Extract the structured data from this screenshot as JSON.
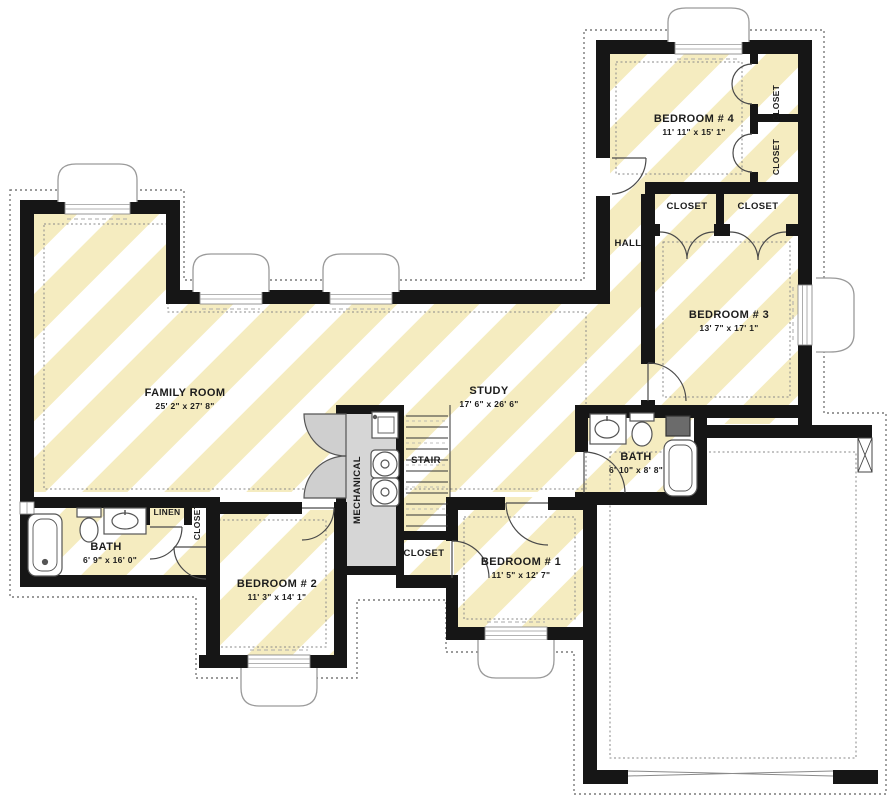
{
  "plan": {
    "type": "floor-plan",
    "level": "basement",
    "colors": {
      "wall": "#161616",
      "stripe_yellow": "#f5ecc0",
      "mechanical_fill": "#d6d6d6",
      "door_leaf_fill": "#cfcfcf",
      "dotted_line": "#7a7a7a",
      "fixture_stroke": "#555555"
    },
    "rooms": [
      {
        "id": "family-room",
        "name": "FAMILY ROOM",
        "dims": "25' 2\" x 27' 8\""
      },
      {
        "id": "study",
        "name": "STUDY",
        "dims": "17' 6\" x 26' 6\""
      },
      {
        "id": "bedroom-4",
        "name": "BEDROOM # 4",
        "dims": "11' 11\" x 15' 1\""
      },
      {
        "id": "bedroom-3",
        "name": "BEDROOM # 3",
        "dims": "13' 7\" x 17' 1\""
      },
      {
        "id": "bedroom-2",
        "name": "BEDROOM # 2",
        "dims": "11' 3\" x 14' 1\""
      },
      {
        "id": "bedroom-1",
        "name": "BEDROOM # 1",
        "dims": "11' 5\" x 12' 7\""
      },
      {
        "id": "bath-main",
        "name": "BATH",
        "dims": "6' 9\" x 16' 0\""
      },
      {
        "id": "bath-2",
        "name": "BATH",
        "dims": "6' 10\" x 8' 8\""
      }
    ],
    "labels": {
      "hall": "HALL",
      "stair": "STAIR",
      "mechanical": "MECHANICAL",
      "linen": "LINEN",
      "closet": "CLOSET"
    }
  }
}
